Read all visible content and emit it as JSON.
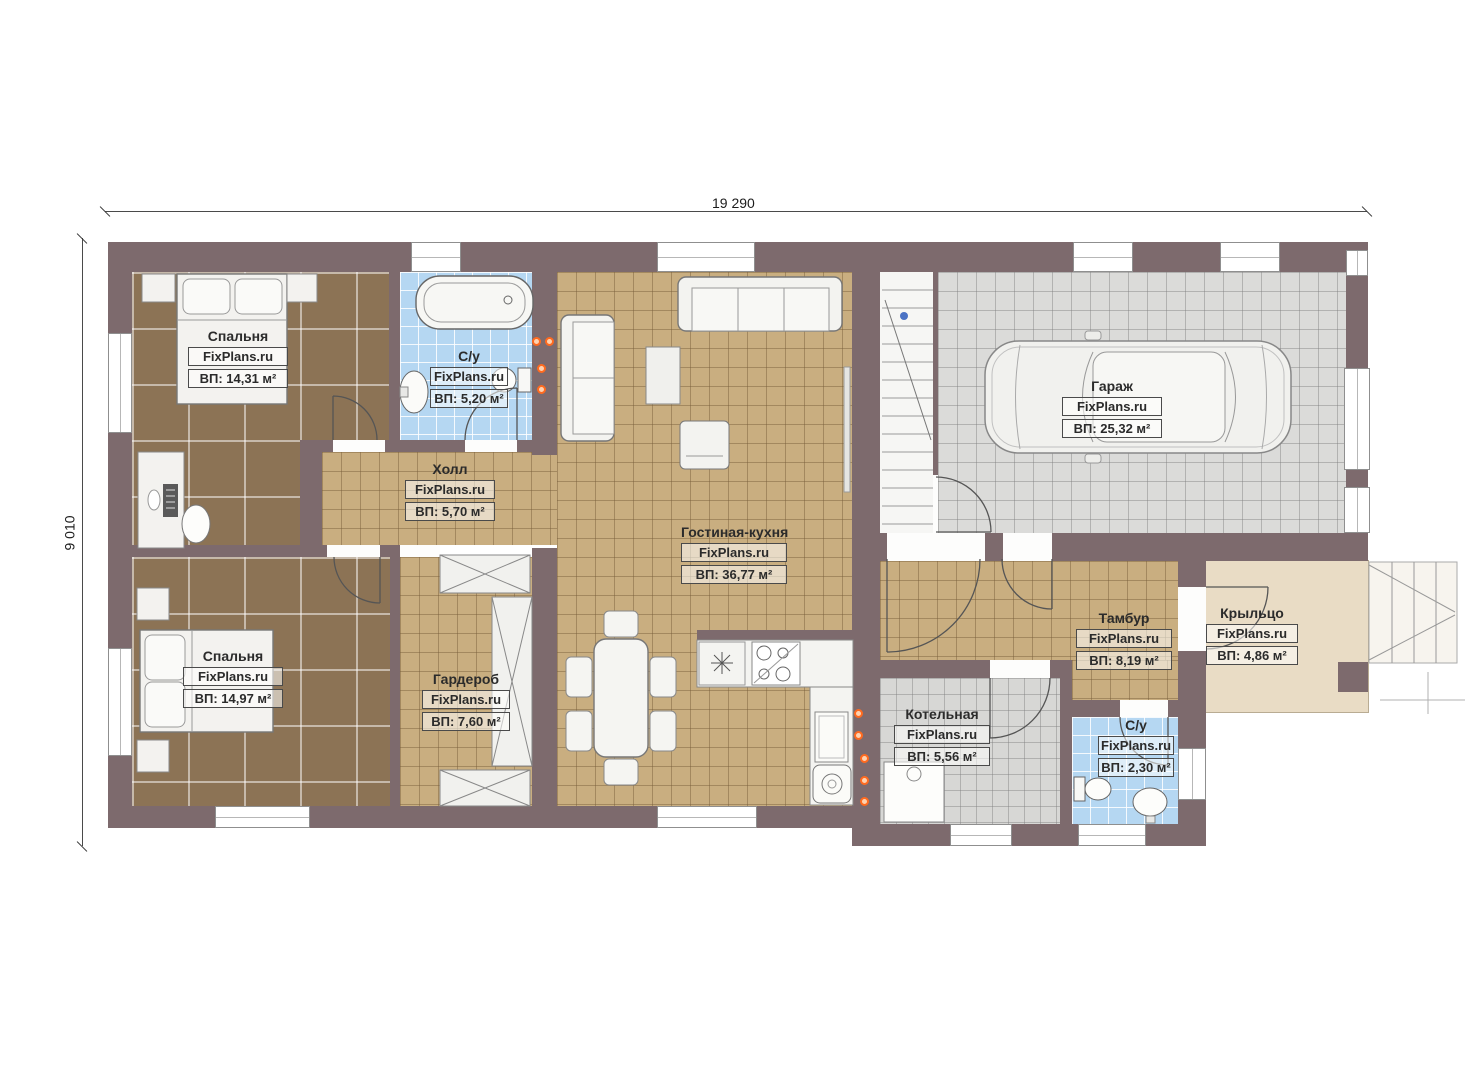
{
  "brand": "FixPlans.ru",
  "dimensions": {
    "width": "19 290",
    "height": "9 010"
  },
  "rooms": [
    {
      "id": "bedroom-1",
      "name": "Спальня",
      "area": "ВП: 14,31 м²"
    },
    {
      "id": "bathroom-1",
      "name": "С/у",
      "area": "ВП: 5,20 м²"
    },
    {
      "id": "hall",
      "name": "Холл",
      "area": "ВП: 5,70 м²"
    },
    {
      "id": "living-kitchen",
      "name": "Гостиная-кухня",
      "area": "ВП: 36,77 м²"
    },
    {
      "id": "garage",
      "name": "Гараж",
      "area": "ВП: 25,32 м²"
    },
    {
      "id": "bedroom-2",
      "name": "Спальня",
      "area": "ВП: 14,97 м²"
    },
    {
      "id": "wardrobe",
      "name": "Гардероб",
      "area": "ВП: 7,60 м²"
    },
    {
      "id": "vestibule",
      "name": "Тамбур",
      "area": "ВП: 8,19 м²"
    },
    {
      "id": "porch",
      "name": "Крыльцо",
      "area": "ВП: 4,86 м²"
    },
    {
      "id": "boiler-room",
      "name": "Котельная",
      "area": "ВП: 5,56 м²"
    },
    {
      "id": "bathroom-2",
      "name": "С/у",
      "area": "ВП: 2,30 м²"
    }
  ],
  "colors": {
    "wall": "#7d6a6d",
    "floor_bedroom": "#8c7355",
    "floor_tile": "#c9ae80",
    "floor_bath": "#b5d7f2",
    "floor_garage": "#dbdbd9",
    "floor_porch": "#e9dcc5",
    "accent_orange": "#ff6a1f"
  }
}
